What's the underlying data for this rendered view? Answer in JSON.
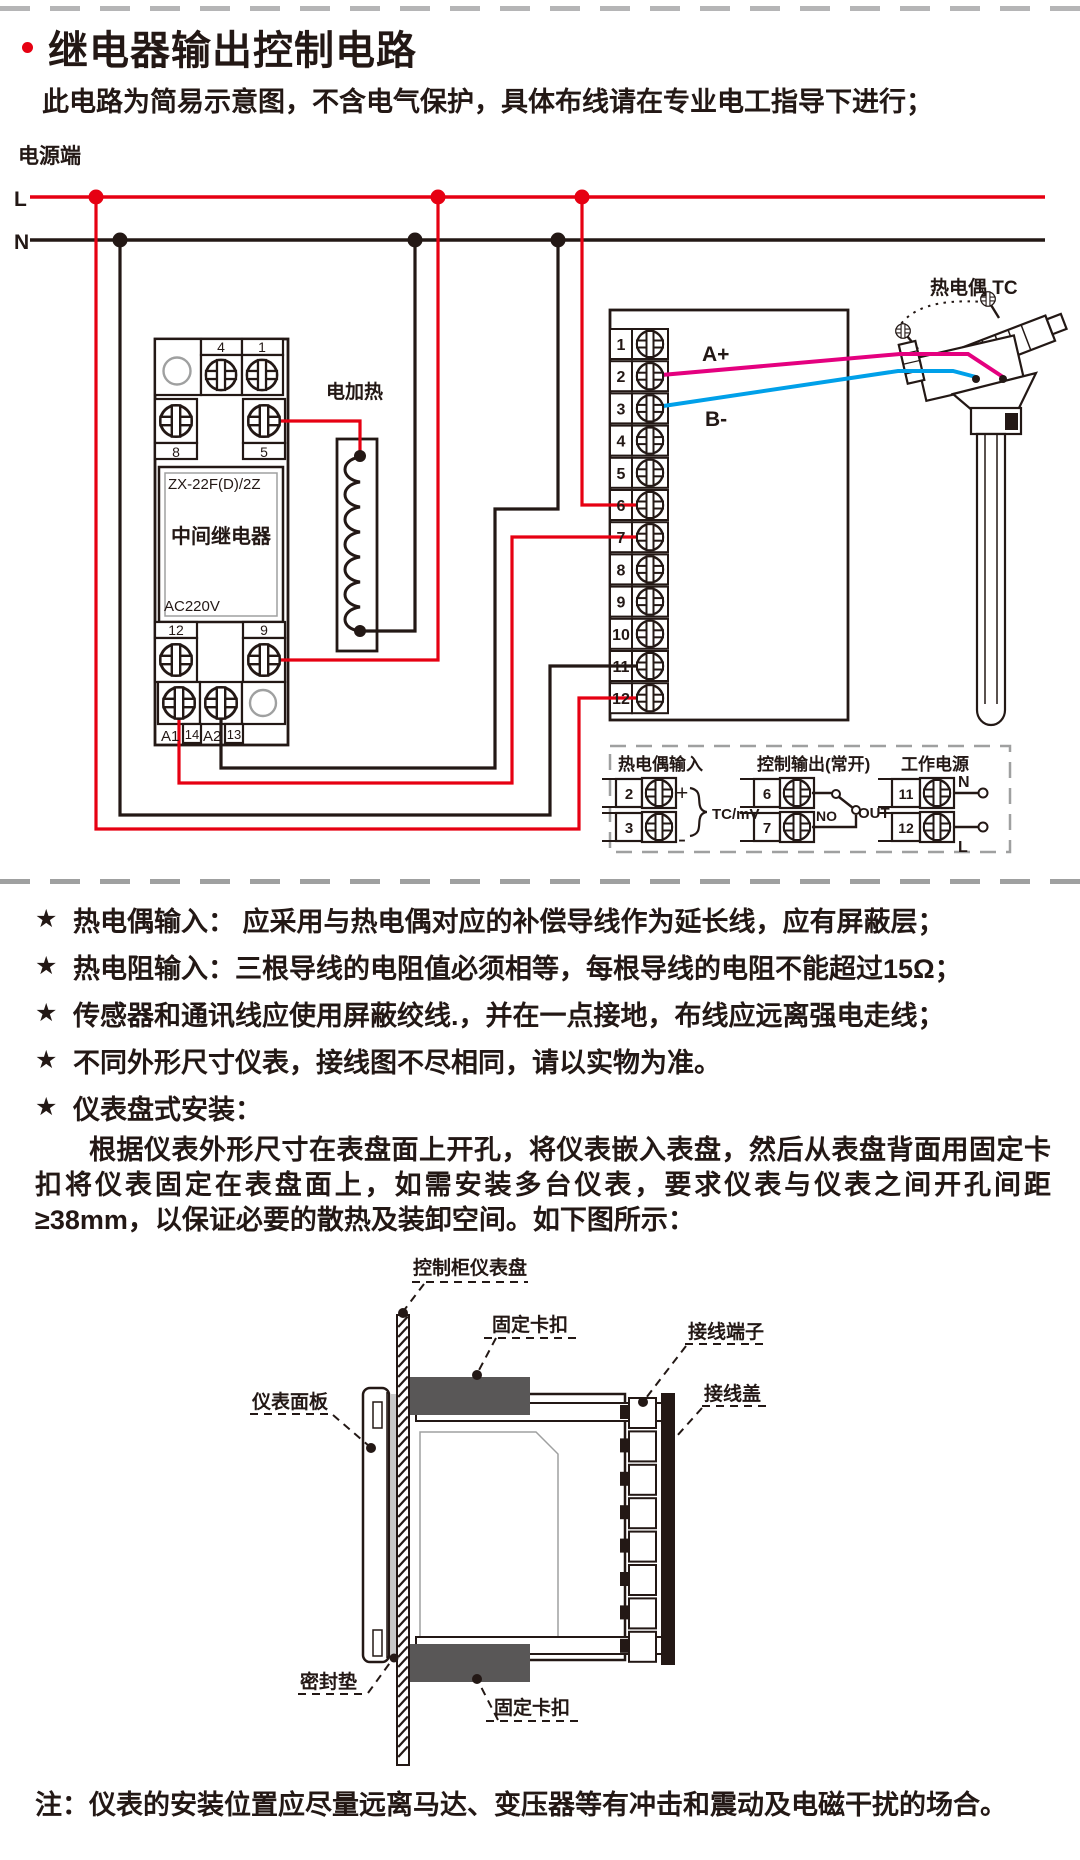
{
  "page": {
    "title": "继电器输出控制电路",
    "subtitle": "此电路为简易示意图，不含电气保护，具体布线请在专业电工指导下进行；",
    "bottom_note": "注：仪表的安装位置应尽量远离马达、变压器等有冲击和震动及电磁干扰的场合。"
  },
  "ui": {
    "star": "★"
  },
  "colors": {
    "wire_red": "#e60012",
    "wire_black": "#231815",
    "wire_pink": "#e4007f",
    "wire_blue": "#00a0e9",
    "clip_gray": "#595757",
    "dash_gray": "#9fa0a0"
  },
  "circuit": {
    "power_label": "电源端",
    "l": "L",
    "n": "N",
    "heater_label": "电加热",
    "thermocouple_label": "热电偶 TC",
    "relay": {
      "model": "ZX-22F(D)/2Z",
      "name": "中间继电器",
      "voltage": "AC220V",
      "t4": "4",
      "t1": "1",
      "t8": "8",
      "t5": "5",
      "t12": "12",
      "t9": "9",
      "a1": "A1",
      "n14": "14",
      "a2": "A2",
      "n13": "13"
    },
    "instrument": {
      "terminals": [
        "1",
        "2",
        "3",
        "4",
        "5",
        "6",
        "7",
        "8",
        "9",
        "10",
        "11",
        "12"
      ],
      "wire_a": "A+",
      "wire_b": "B-"
    },
    "legend": {
      "tc_input": {
        "title": "热电偶输入",
        "t_top": "2",
        "t_bot": "3",
        "plus": "+",
        "minus": "-",
        "signal": "TC/mV"
      },
      "ctrl_output": {
        "title": "控制输出(常开)",
        "t_top": "6",
        "t_bot": "7",
        "no": "NO",
        "out": "OUT"
      },
      "power": {
        "title": "工作电源",
        "t_top": "11",
        "t_bot": "12",
        "n": "N",
        "l": "L"
      }
    }
  },
  "notes": [
    "热电偶输入： 应采用与热电偶对应的补偿导线作为延长线，应有屏蔽层；",
    "热电阻输入：三根导线的电阻值必须相等，每根导线的电阻不能超过15Ω；",
    "传感器和通讯线应使用屏蔽绞线.，并在一点接地，布线应远离强电走线；",
    "不同外形尺寸仪表，接线图不尽相同，请以实物为准。",
    "仪表盘式安装："
  ],
  "install": {
    "paragraph": "根据仪表外形尺寸在表盘面上开孔，将仪表嵌入表盘，然后从表盘背面用固定卡扣将仪表固定在表盘面上，如需安装多台仪表，要求仪表与仪表之间开孔间距≥38mm，以保证必要的散热及装卸空间。如下图所示：",
    "labels": {
      "panel": "控制柜仪表盘",
      "clip_top": "固定卡扣",
      "front_panel": "仪表面板",
      "terminal_block": "接线端子",
      "terminal_cover": "接线盖",
      "gasket": "密封垫",
      "clip_bottom": "固定卡扣"
    }
  }
}
